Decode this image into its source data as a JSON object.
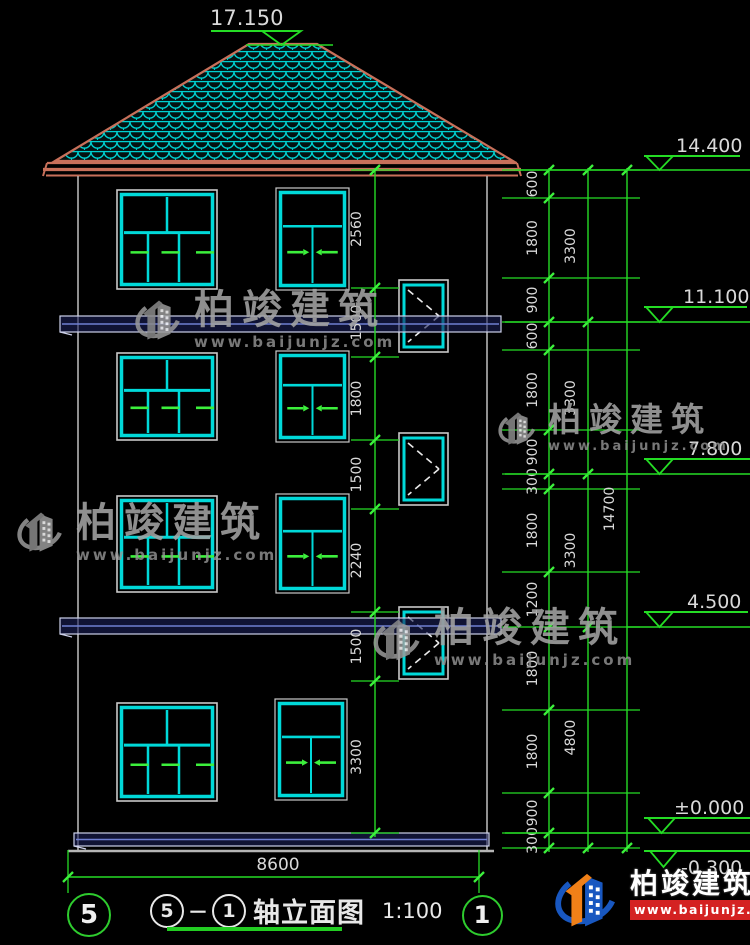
{
  "colors": {
    "background": "#000000",
    "cad_green": "#25dc25",
    "bright_green": "#3cf03c",
    "dim_text": "#d9d9d9",
    "window_cyan": "#00d9d9",
    "frame_white": "#c9c9c9",
    "roof_edge": "#c8705a",
    "roof_tile": "#00cfcf",
    "slab_fill": "#1a2056",
    "slab_mid": "#6f7fd2",
    "slab_edge": "#ccd0ea",
    "wall_gray": "#b5b5b5",
    "dash_white": "#e8e8e8",
    "watermark_gray": "#a3a3a3",
    "logo_blue": "#1857c0",
    "logo_orange": "#f08018",
    "banner_red": "#d42222"
  },
  "watermark": {
    "brand": "柏竣建筑",
    "url": "www.baijunjz.com"
  },
  "watermarks_layout": [
    {
      "x": 130,
      "y": 290,
      "logo_w": 58,
      "logo_h": 66,
      "brand_size": 40,
      "url_size": 15
    },
    {
      "x": 12,
      "y": 503,
      "logo_w": 58,
      "logo_h": 64,
      "brand_size": 40,
      "url_size": 15
    },
    {
      "x": 494,
      "y": 403,
      "logo_w": 48,
      "logo_h": 56,
      "brand_size": 33,
      "url_size": 13
    },
    {
      "x": 368,
      "y": 608,
      "logo_w": 60,
      "logo_h": 70,
      "brand_size": 40,
      "url_size": 15
    }
  ],
  "footer_logo": {
    "brand": "柏竣建筑",
    "url": "www.baijunjz.com"
  },
  "title_block": {
    "axis_left": "5",
    "axis_right": "1",
    "name": "轴立面图",
    "scale": "1:100"
  },
  "axis_bubbles": [
    {
      "label": "5",
      "cx": 87,
      "cy": 913,
      "d": 40,
      "font": 26
    },
    {
      "label": "1",
      "cx": 480,
      "cy": 913,
      "d": 37,
      "font": 24
    }
  ],
  "elevation_markers": [
    {
      "value": "17.150",
      "text_x": 210,
      "text_y": 25,
      "text_size": 21,
      "bar_x1": 211,
      "bar_x2": 299,
      "bar_y": 31,
      "tri_x": 262,
      "tri_w": 39,
      "tri_h": 14,
      "level_x1": 246,
      "level_x2": 333,
      "level_y": 45
    },
    {
      "value": "14.400",
      "text_x": 676,
      "text_y": 152,
      "text_size": 19,
      "bar_x1": 644,
      "bar_x2": 740,
      "bar_y": 156,
      "tri_x": 646,
      "tri_w": 27,
      "tri_h": 14,
      "level_x1": 515,
      "level_x2": 757,
      "level_y": 170
    },
    {
      "value": "11.100",
      "text_x": 683,
      "text_y": 303,
      "text_size": 19,
      "bar_x1": 644,
      "bar_x2": 747,
      "bar_y": 307,
      "tri_x": 646,
      "tri_w": 27,
      "tri_h": 15,
      "level_x1": 505,
      "level_x2": 757,
      "level_y": 322
    },
    {
      "value": "7.800",
      "text_x": 688,
      "text_y": 455,
      "text_size": 19,
      "bar_x1": 644,
      "bar_x2": 750,
      "bar_y": 459,
      "tri_x": 646,
      "tri_w": 27,
      "tri_h": 15,
      "level_x1": 505,
      "level_x2": 757,
      "level_y": 474
    },
    {
      "value": "4.500",
      "text_x": 687,
      "text_y": 608,
      "text_size": 19,
      "bar_x1": 644,
      "bar_x2": 748,
      "bar_y": 612,
      "tri_x": 646,
      "tri_w": 27,
      "tri_h": 15,
      "level_x1": 627,
      "level_x2": 752,
      "level_y": 627
    },
    {
      "value": "±0.000",
      "text_x": 674,
      "text_y": 814,
      "text_size": 19,
      "bar_x1": 644,
      "bar_x2": 750,
      "bar_y": 818,
      "tri_x": 648,
      "tri_w": 27,
      "tri_h": 15,
      "level_x1": 505,
      "level_x2": 757,
      "level_y": 833
    },
    {
      "value": "-0.300",
      "text_x": 681,
      "text_y": 874,
      "text_size": 19,
      "bar_x1": 644,
      "bar_x2": 752,
      "bar_y": 851,
      "tri_x": 650,
      "tri_w": 27,
      "tri_h": 16,
      "level_x1": null,
      "level_x2": null,
      "level_y": null
    }
  ],
  "dim_chains": [
    {
      "line_x": 549,
      "label_x": 537,
      "stub_x1": 502,
      "stub_x2": 640,
      "bounds": [
        170,
        198,
        278,
        322,
        350,
        430,
        474,
        489,
        572,
        627,
        710,
        793,
        833,
        848
      ],
      "labels": [
        "600",
        "1800",
        "900",
        "600",
        "1800",
        "900",
        "300",
        "1800",
        "1200",
        "1800",
        "1800",
        "900",
        "300"
      ]
    },
    {
      "line_x": 588,
      "label_x": 575,
      "stub_x1": null,
      "stub_x2": null,
      "bounds": [
        170,
        322,
        474,
        627,
        848
      ],
      "labels": [
        "3300",
        "3300",
        "3300",
        "4800"
      ]
    },
    {
      "line_x": 627,
      "label_x": 614,
      "stub_x1": null,
      "stub_x2": null,
      "bounds": [
        170,
        848
      ],
      "labels": [
        "14700"
      ]
    },
    {
      "line_x": 375,
      "label_x": 361,
      "stub_x1": 351,
      "stub_x2": 399,
      "bounds": [
        170,
        288,
        357,
        440,
        509,
        612,
        681,
        833
      ],
      "labels": [
        "2560",
        "1500",
        "1800",
        "1500",
        "2240",
        "1500",
        "3300"
      ]
    }
  ],
  "bottom_dim": {
    "label": "8600",
    "label_x": 250,
    "label_y": 870,
    "line_y": 877,
    "x1": 68,
    "x2": 479,
    "ext_y1": 850,
    "ext_y2": 893
  },
  "building": {
    "roof": {
      "polygon": "55,161 249,44 317,44 513,161",
      "eaves": [
        [
          47,
          163,
          517,
          163,
          2.2
        ],
        [
          43,
          169.5,
          521,
          169.5,
          3.2
        ],
        [
          46,
          175.5,
          518,
          175.5,
          2
        ]
      ]
    },
    "walls": [
      [
        78,
        176,
        78,
        850
      ],
      [
        487,
        176,
        487,
        850
      ]
    ],
    "ground_lines": [
      [
        68,
        851,
        494,
        851,
        2.4
      ]
    ],
    "slabs": [
      {
        "x": 60,
        "y": 316,
        "w": 441,
        "h": 16
      },
      {
        "x": 60,
        "y": 618,
        "w": 441,
        "h": 16
      },
      {
        "x": 74,
        "y": 833,
        "w": 415,
        "h": 13
      }
    ],
    "windows_main": [
      {
        "type": "w5",
        "x": 117,
        "y": 190,
        "w": 100,
        "h": 99
      },
      {
        "type": "w3",
        "x": 278,
        "y": 190,
        "w": 69,
        "h": 98
      },
      {
        "type": "w5",
        "x": 117,
        "y": 353,
        "w": 100,
        "h": 87
      },
      {
        "type": "w3",
        "x": 278,
        "y": 353,
        "w": 69,
        "h": 87
      },
      {
        "type": "w5",
        "x": 117,
        "y": 496,
        "w": 100,
        "h": 96
      },
      {
        "type": "w3",
        "x": 278,
        "y": 496,
        "w": 69,
        "h": 95
      },
      {
        "type": "w5",
        "x": 117,
        "y": 703,
        "w": 100,
        "h": 98
      },
      {
        "type": "w3",
        "x": 277,
        "y": 701,
        "w": 68,
        "h": 97
      }
    ],
    "windows_stair": [
      {
        "x": 399,
        "y": 280,
        "w": 49,
        "h": 72
      },
      {
        "x": 399,
        "y": 433,
        "w": 49,
        "h": 72
      },
      {
        "x": 399,
        "y": 607,
        "w": 49,
        "h": 72
      }
    ]
  }
}
